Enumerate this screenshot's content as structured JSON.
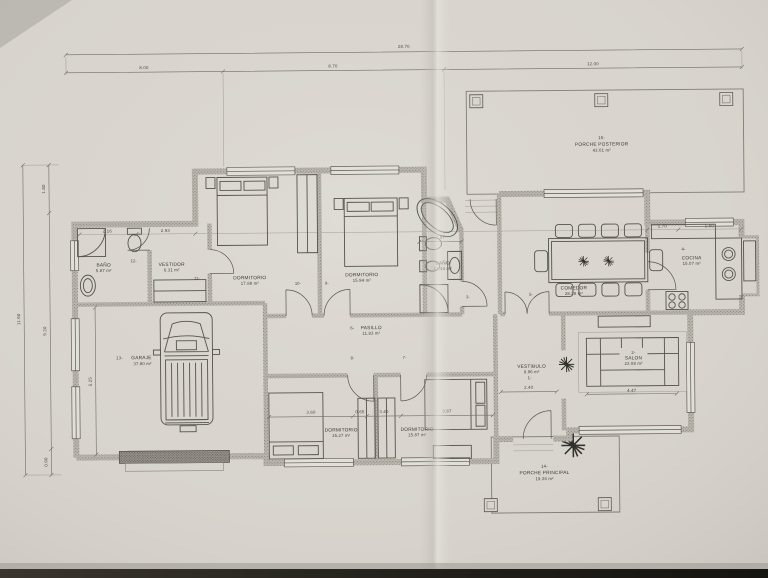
{
  "dims": {
    "top_total": "28.70",
    "top_seg_left": "8.00",
    "top_seg_mid": "8.70",
    "top_seg_right": "12.00",
    "left_total": "11.90",
    "left_seg_top": "1.80",
    "left_seg_mid": "9.20",
    "left_seg_bottom": "0.90",
    "garage_depth": "5.25",
    "bano1_width": "2.16",
    "vestidor_width": "2.93",
    "bath2_width": "2.87",
    "cocina_seg1": "1.70",
    "cocina_seg2": "1.60",
    "dorm3_width": "3.60",
    "dorm_gap": "0.65",
    "dorm3_inner": "3.40",
    "dorm4_width": "3.87",
    "vestibulo_width": "2.40",
    "salon_width": "4.47"
  },
  "rooms": {
    "vestibulo": {
      "num": "1-",
      "name": "VESTIBULO",
      "area": "9.96 m²"
    },
    "salon": {
      "num": "2-",
      "name": "SALON",
      "area": "23.08 m²"
    },
    "cocina": {
      "num": "4-",
      "name": "COCINA",
      "area": "15.07 m²"
    },
    "comedor": {
      "name": "COMEDOR",
      "area": "28.28 m²"
    },
    "pasillo": {
      "num": "6-",
      "name": "PASILLO",
      "area": "11.83 m²"
    },
    "dorm1": {
      "name": "DORMITORIO",
      "area": "17.88 m²"
    },
    "dorm2": {
      "name": "DORMITORIO",
      "area": "15.94 m²"
    },
    "dorm3": {
      "name": "DORMITORIO",
      "area": "15.27 m²"
    },
    "dorm4": {
      "name": "DORMITORIO",
      "area": "15.87 m²"
    },
    "bano1": {
      "name": "BAÑO",
      "area": "5.87 m²"
    },
    "bano2": {
      "name": "BAÑO",
      "area": "13.44 m²"
    },
    "vestidor": {
      "name": "VESTIDOR",
      "area": "6.31 m²"
    },
    "garaje": {
      "num": "13-",
      "name": "GARAJE",
      "area": "37.80 m²"
    },
    "porche_principal": {
      "num": "14-",
      "name": "PORCHE PRINCIPAL",
      "area": "19.36 m²"
    },
    "porche_posterior": {
      "num": "15-",
      "name": "PORCHE POSTERIOR",
      "area": "43.01 m²"
    }
  },
  "door_labels": {
    "d3": "3-",
    "d5": "5-",
    "d7": "7-",
    "d8": "8-",
    "d9": "9-",
    "d10": "10-",
    "d11": "11-",
    "d12": "12-"
  }
}
